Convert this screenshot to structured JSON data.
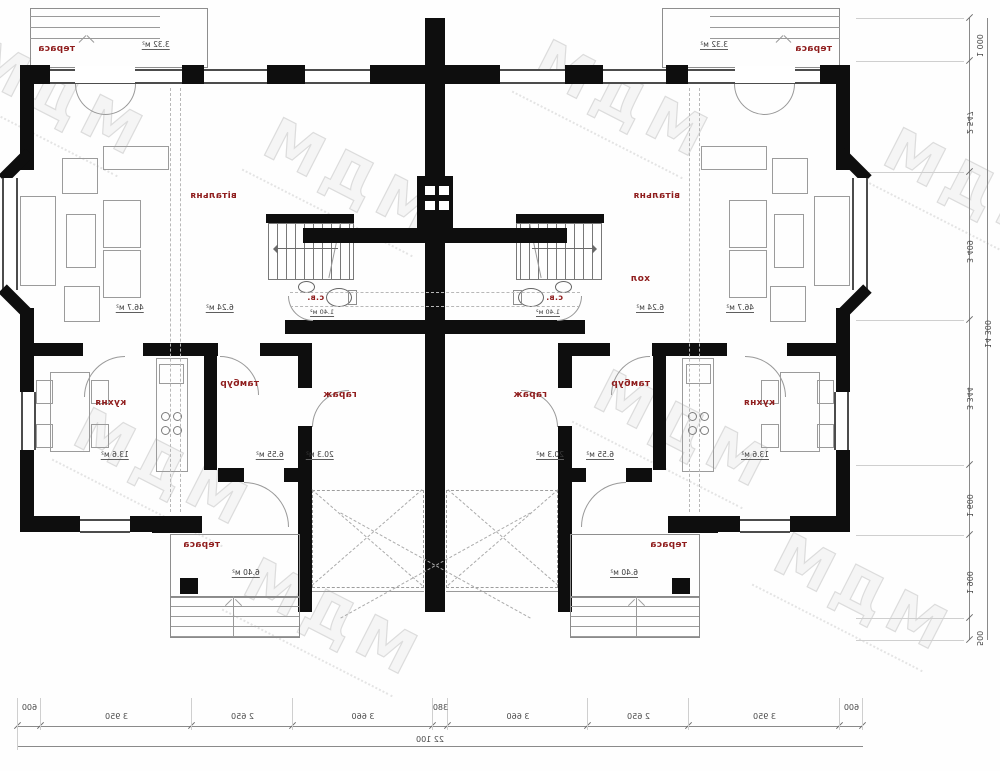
{
  "plan": {
    "rooms": {
      "terrace_top": {
        "label": "тераса",
        "area": "3.32 м²"
      },
      "living": {
        "label": "вітальня",
        "area": "46.7 м²"
      },
      "hall": {
        "label": "хол",
        "area": "6.24 м²"
      },
      "wc": {
        "label": "с.в.",
        "area": "1.40 м²"
      },
      "kitchen": {
        "label": "кухня",
        "area": "13.6 м²"
      },
      "vestibule": {
        "label": "тамбур",
        "area": "6.55 м²"
      },
      "garage": {
        "label": "гараж",
        "area": "20.3 м²"
      },
      "terrace_bottom": {
        "label": "тераса",
        "area": "6.40 м²"
      }
    }
  },
  "dimensions": {
    "bottom": {
      "segments": [
        "600",
        "3 950",
        "2 650",
        "3 660",
        "380",
        "3 660",
        "2 650",
        "3 950",
        "600"
      ],
      "total": "22 100"
    },
    "side": {
      "segments": [
        "1 000",
        "2 547",
        "3 409",
        "3 344",
        "1 600",
        "1 900",
        "500"
      ],
      "total": "14 300"
    }
  },
  "watermark": {
    "text": "МДМ"
  }
}
